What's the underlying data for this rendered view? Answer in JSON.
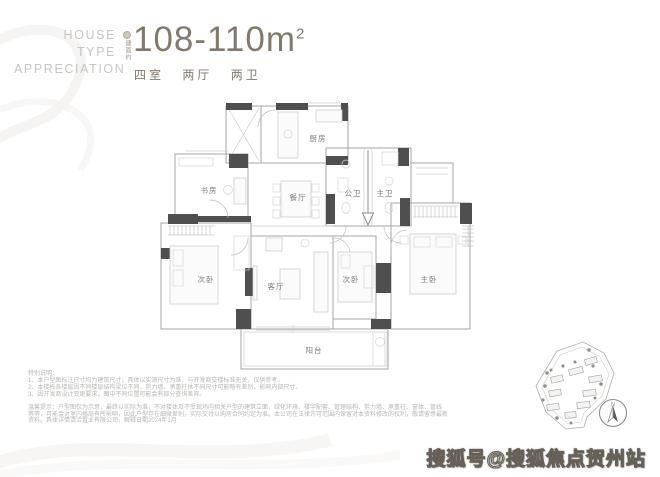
{
  "header": {
    "title_lines": [
      "HOUSE",
      "TYPE",
      "APPRECIATION"
    ],
    "area_prefix": "建面约",
    "area_value": "108-110m",
    "area_sup": "2",
    "specs": [
      "四室",
      "两厅",
      "两卫"
    ],
    "accent_color": "#837a6f",
    "muted_color": "#c7c5c2"
  },
  "floorplan": {
    "rooms": {
      "study": "书房",
      "kitchen": "厨房",
      "dining": "餐厅",
      "guest_bath": "公卫",
      "master_bath": "主卫",
      "bedroom2": "次卧",
      "living": "客厅",
      "bedroom3": "次卧",
      "master_bedroom": "主卧",
      "balcony": "阳台"
    },
    "colors": {
      "wall_dark": "#4f4f4f",
      "wall_line": "#a6a6a6",
      "furniture": "#d5d5d5",
      "label": "#7d7d7d"
    }
  },
  "disclaimer": {
    "heading": "特别说明：",
    "notes": [
      "1、本户型图标注尺寸均为建筑尺寸，具体以实测尺寸为准，与开发商交楼标准无关，仅供参考。",
      "2、本楼栋各楼层因不同楼层结构梁位不同，剪力墙、承重柱体不同尺寸可能略有差别，影响内部尺寸。",
      "3、因开发商设计变更要求，图中不同位置可能会有部分查询差异。"
    ],
    "paragraph_lines": [
      "温馨提示：户型图仅为示意，最终以实际为准，不对楼体及不受现场内相关户型的建筑立面、绿化环境、楼宇配套、管理结构、剪力墙、承重柱、窗体、管线",
      "等等，可能会对室内格局有所影响，因此户型存在细微差别，实际交付以购房合同约定为准。本公司在法律许可范围内保留对本资料修改的权利，敬请留意最新",
      "资料。具体详情请洽置业有限公司，解释日期2024年1月"
    ]
  },
  "siteplan": {
    "compass_label": "N"
  },
  "watermark": "搜狐号@搜狐焦点贺州站"
}
